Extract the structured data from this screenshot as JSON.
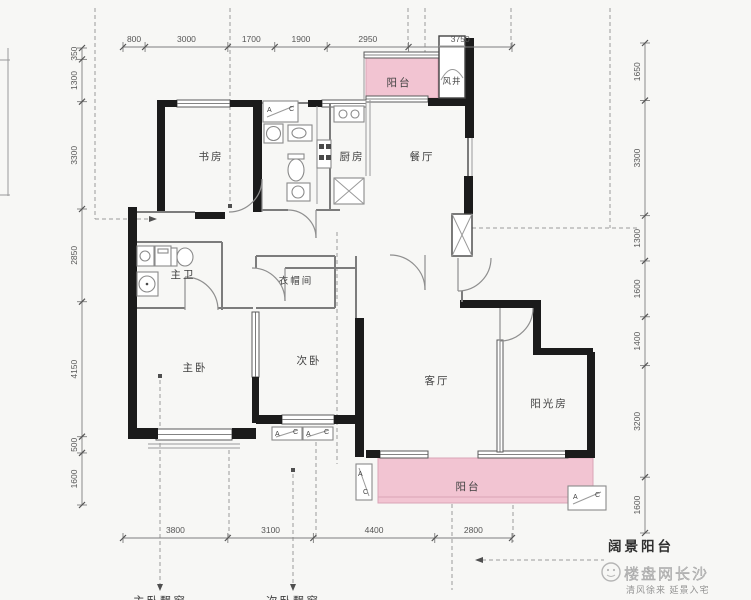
{
  "colors": {
    "balcony_pink": "#F2C4D2",
    "balcony_pink_border": "#D9A4B7",
    "wall": "#1b1b1b"
  },
  "rooms": {
    "study": "书房",
    "kitchen": "厨房",
    "dining": "餐厅",
    "balcony_top": "阳台",
    "air_shaft": "风井",
    "master_bath": "主卫",
    "cloakroom": "衣帽间",
    "master_bedroom": "主卧",
    "second_bedroom": "次卧",
    "living": "客厅",
    "sunroom": "阳光房",
    "balcony_bottom": "阳台"
  },
  "dimensions": {
    "top": [
      800,
      3000,
      1700,
      1900,
      2950,
      3750
    ],
    "bottom": [
      3800,
      3100,
      4400,
      2800
    ],
    "left": [
      350,
      1300,
      3300,
      2850,
      4150,
      500,
      1600
    ],
    "right": [
      1650,
      3300,
      1300,
      1600,
      1400,
      3200,
      1600
    ]
  },
  "ac": {
    "a": "A",
    "c": "C"
  },
  "callout": {
    "wide_balcony": "阔景阳台"
  },
  "cut_labels": {
    "left": "主卧飘窗",
    "right": "次卧飘窗"
  },
  "watermark": {
    "brand": "楼盘网长沙",
    "slogan": "清风徐来 延景入宅"
  }
}
